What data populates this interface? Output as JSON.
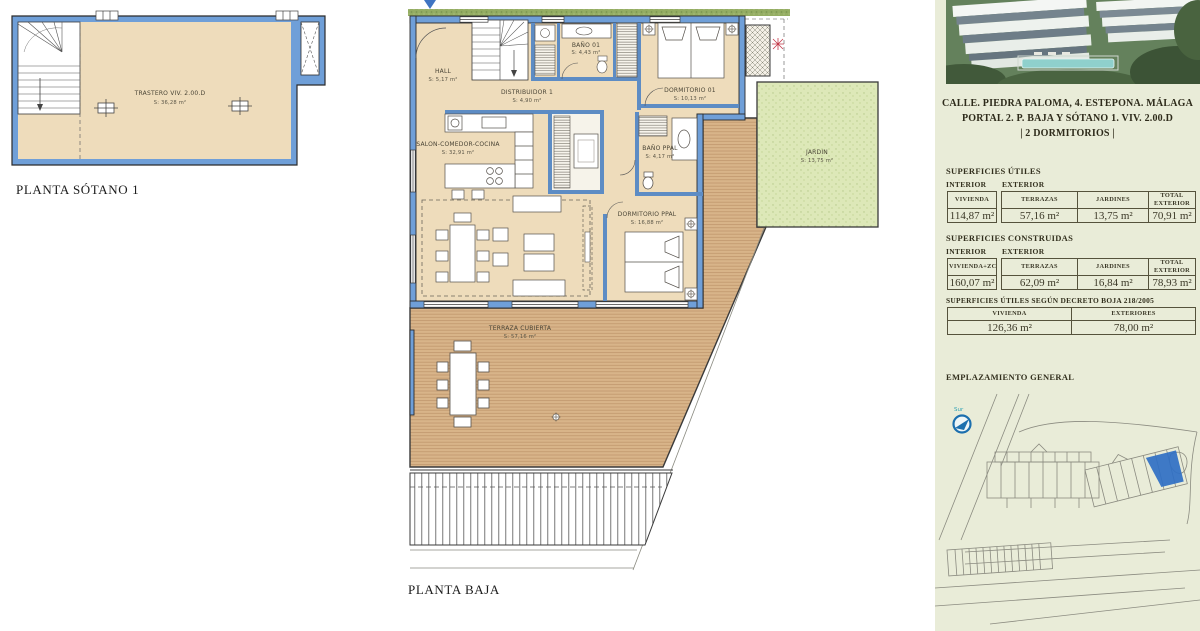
{
  "colors": {
    "wall_blue": "#6f9fd8",
    "floor_cream": "#eedcbb",
    "deck_wood": "#d8b489",
    "garden_green": "#dde8b8",
    "hedge_green": "#94ad63",
    "panel_bg": "#e9ecd8",
    "highlight_blue": "#2f6fc4",
    "map_line": "#8b8b80"
  },
  "basement": {
    "title": "PLANTA SÓTANO 1",
    "room_name": "TRASTERO VIV. 2.00.D",
    "room_area": "S: 36,28 m²"
  },
  "main_plan": {
    "title": "PLANTA BAJA",
    "rooms": {
      "hall": {
        "n": "HALL",
        "a": "S: 5,17 m²"
      },
      "distribuidor": {
        "n": "DISTRIBUIDOR 1",
        "a": "S: 4,90 m²"
      },
      "bano01": {
        "n": "BAÑO 01",
        "a": "S: 4,43 m²"
      },
      "dormitorio01": {
        "n": "DORMITORIO 01",
        "a": "S: 10,13 m²"
      },
      "salon": {
        "n": "SALON-COMEDOR-COCINA",
        "a": "S: 32,91 m²"
      },
      "banoppal": {
        "n": "BAÑO PPAL",
        "a": "S: 4,17 m²"
      },
      "dormitorioppal": {
        "n": "DORMITORIO PPAL",
        "a": "S: 16,88 m²"
      },
      "jardin": {
        "n": "JARDIN",
        "a": "S: 13,75 m²"
      },
      "terraza": {
        "n": "TERRAZA CUBIERTA",
        "a": "S: 57,16 m²"
      }
    }
  },
  "panel": {
    "address1": "CALLE. PIEDRA PALOMA, 4. ESTEPONA. MÁLAGA",
    "address2": "PORTAL 2. P. BAJA Y SÓTANO 1. VIV. 2.00.D",
    "address3": "| 2 DORMITORIOS |",
    "utiles": {
      "title": "SUPERFICIES ÚTILES",
      "interior": "INTERIOR",
      "exterior": "EXTERIOR",
      "col_interior": "VIVIENDA",
      "val_interior": "114,87 m²",
      "cols": [
        "TERRAZAS",
        "JARDINES",
        "TOTAL EXTERIOR"
      ],
      "vals": [
        "57,16 m²",
        "13,75 m²",
        "70,91 m²"
      ]
    },
    "construidas": {
      "title": "SUPERFICIES CONSTRUIDAS",
      "interior": "INTERIOR",
      "exterior": "EXTERIOR",
      "col_interior": "VIVIENDA+ZCC",
      "val_interior": "160,07 m²",
      "cols": [
        "TERRAZAS",
        "JARDINES",
        "TOTAL EXTERIOR"
      ],
      "vals": [
        "62,09 m²",
        "16,84 m²",
        "78,93 m²"
      ]
    },
    "decreto": {
      "title": "SUPERFICIES ÚTILES SEGÚN DECRETO BOJA 218/2005",
      "cols": [
        "VIVIENDA",
        "EXTERIORES"
      ],
      "vals": [
        "126,36 m²",
        "78,00 m²"
      ]
    },
    "emplazamiento": "EMPLAZAMIENTO GENERAL",
    "compass_label": "Sur"
  }
}
